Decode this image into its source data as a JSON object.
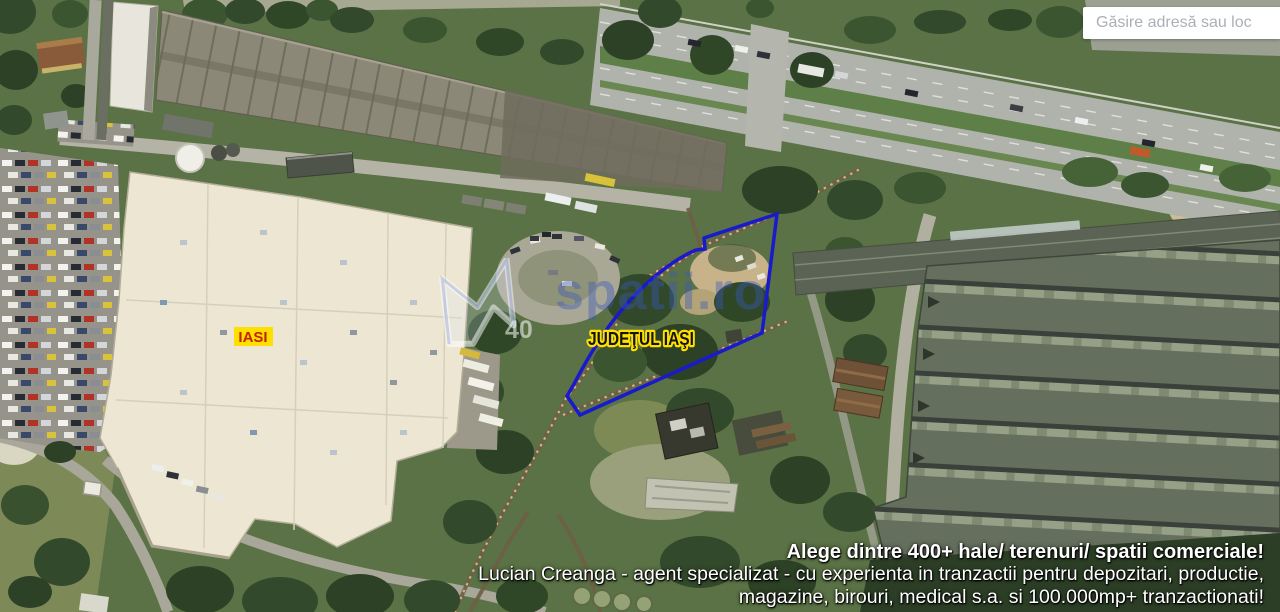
{
  "search": {
    "placeholder": "Găsire adresă sau loc"
  },
  "map": {
    "labels": {
      "city": "IASI",
      "county": "JUDEŢUL IAŞI"
    },
    "watermark": {
      "text": "spatii.ro",
      "fragment": "40"
    },
    "colors": {
      "parcel_outline": "#1a1acd",
      "city_label_bg": "#ffdf00",
      "city_label_text": "#c22400",
      "county_label_text": "#141414",
      "county_label_outline": "#ffe000"
    }
  },
  "promo": {
    "line1": "Alege dintre 400+ hale/ terenuri/ spatii comerciale!",
    "line2": "Lucian Creanga - agent specializat - cu experienta in tranzactii pentru depozitari, productie,",
    "line3": "magazine, birouri, medical s.a. si 100.000mp+ tranzactionati!"
  }
}
